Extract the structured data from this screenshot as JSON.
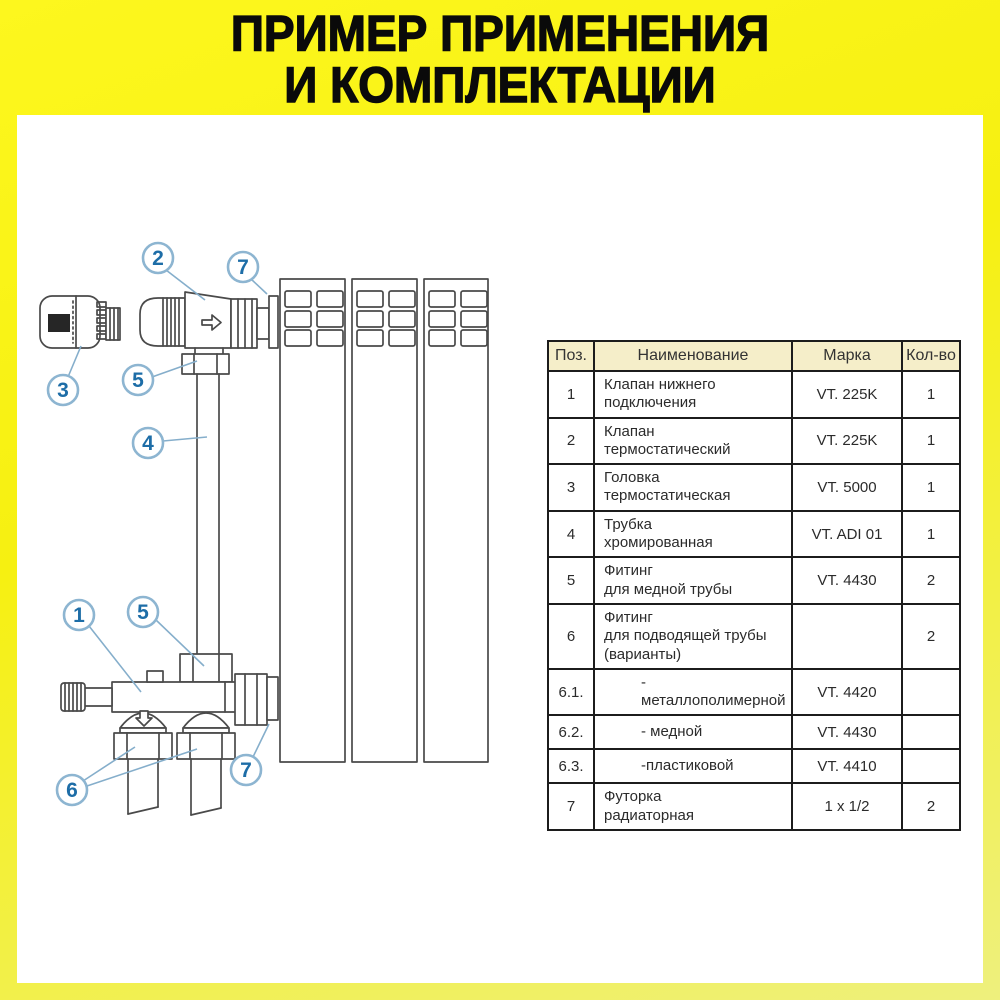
{
  "title": {
    "line1": "ПРИМЕР ПРИМЕНЕНИЯ",
    "line2": "И КОМПЛЕКТАЦИИ"
  },
  "colors": {
    "frame_yellow_top": "#fdf71e",
    "frame_yellow_bottom": "#eef07d",
    "panel_white": "#ffffff",
    "table_header_bg": "#f5eec9",
    "table_border": "#1c1c1c",
    "callout_blue_text": "#1d6da7",
    "callout_blue_stroke": "#8db5d1",
    "drawing_line": "#4a4a4a"
  },
  "diagram": {
    "callouts": [
      {
        "label": "2",
        "x": 141,
        "y": 28
      },
      {
        "label": "7",
        "x": 226,
        "y": 37
      },
      {
        "label": "3",
        "x": 46,
        "y": 160
      },
      {
        "label": "5",
        "x": 121,
        "y": 150
      },
      {
        "label": "4",
        "x": 131,
        "y": 213
      },
      {
        "label": "1",
        "x": 62,
        "y": 385
      },
      {
        "label": "5",
        "x": 126,
        "y": 382
      },
      {
        "label": "6",
        "x": 55,
        "y": 560
      },
      {
        "label": "7",
        "x": 229,
        "y": 540
      }
    ],
    "leaders": [
      {
        "x1": 149,
        "y1": 40,
        "x2": 188,
        "y2": 70
      },
      {
        "x1": 234,
        "y1": 49,
        "x2": 250,
        "y2": 64
      },
      {
        "x1": 51,
        "y1": 147,
        "x2": 64,
        "y2": 116
      },
      {
        "x1": 135,
        "y1": 147,
        "x2": 180,
        "y2": 131
      },
      {
        "x1": 146,
        "y1": 211,
        "x2": 190,
        "y2": 207
      },
      {
        "x1": 72,
        "y1": 396,
        "x2": 124,
        "y2": 462
      },
      {
        "x1": 139,
        "y1": 390,
        "x2": 187,
        "y2": 436
      },
      {
        "x1": 66,
        "y1": 551,
        "x2": 118,
        "y2": 517
      },
      {
        "x1": 70,
        "y1": 556,
        "x2": 180,
        "y2": 519
      },
      {
        "x1": 236,
        "y1": 527,
        "x2": 252,
        "y2": 494
      }
    ]
  },
  "table": {
    "headers": [
      "Поз.",
      "Наименование",
      "Марка",
      "Кол-во"
    ],
    "rows": [
      {
        "pos": "1",
        "name": "Клапан нижнего\nподключения",
        "marka": "VT. 225K",
        "qty": "1",
        "indent": false
      },
      {
        "pos": "2",
        "name": "Клапан\nтермостатический",
        "marka": "VT. 225K",
        "qty": "1",
        "indent": false
      },
      {
        "pos": "3",
        "name": "Головка\nтермостатическая",
        "marka": "VT. 5000",
        "qty": "1",
        "indent": false
      },
      {
        "pos": "4",
        "name": "Трубка\nхромированная",
        "marka": "VT. ADI 01",
        "qty": "1",
        "indent": false
      },
      {
        "pos": "5",
        "name": "Фитинг\nдля медной трубы",
        "marka": "VT. 4430",
        "qty": "2",
        "indent": false
      },
      {
        "pos": "6",
        "name": "Фитинг\nдля подводящей трубы\n(варианты)",
        "marka": "",
        "qty": "2",
        "indent": false
      },
      {
        "pos": "6.1.",
        "name": "- металлополимерной",
        "marka": "VT. 4420",
        "qty": "",
        "indent": true
      },
      {
        "pos": "6.2.",
        "name": "- медной",
        "marka": "VT. 4430",
        "qty": "",
        "indent": true
      },
      {
        "pos": "6.3.",
        "name": "-пластиковой",
        "marka": "VT. 4410",
        "qty": "",
        "indent": true
      },
      {
        "pos": "7",
        "name": "Футорка\nрадиаторная",
        "marka": "1 x 1/2",
        "qty": "2",
        "indent": false
      }
    ]
  }
}
